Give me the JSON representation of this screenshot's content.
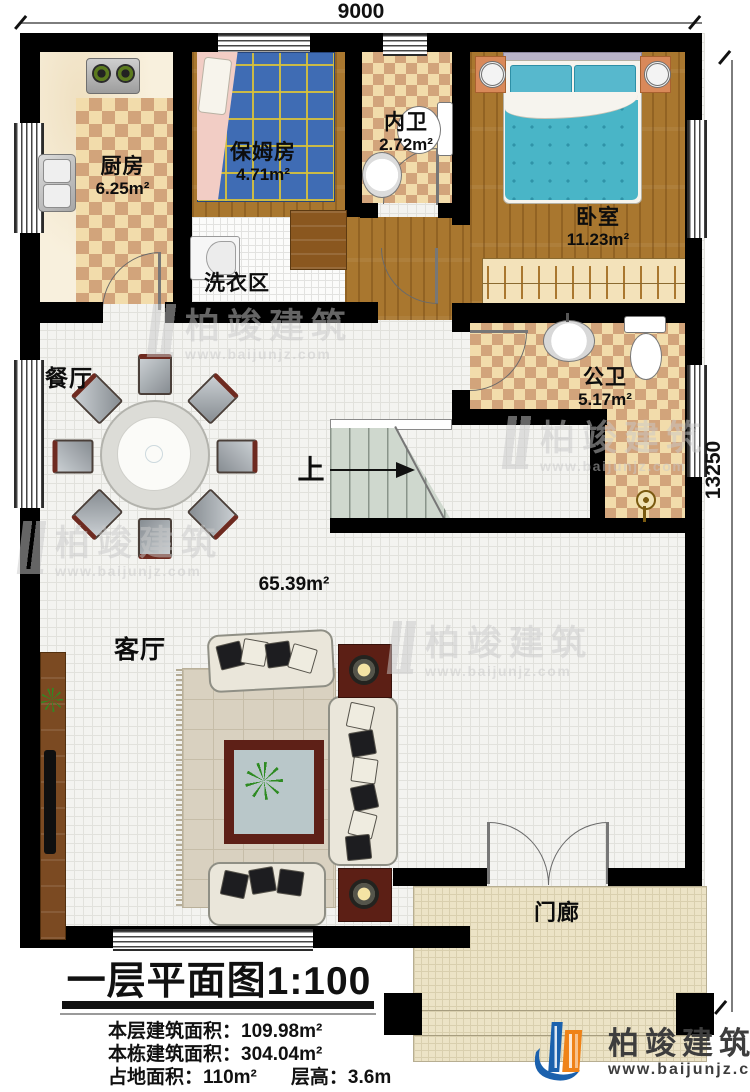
{
  "dimensions": {
    "top": "9000",
    "right": "13250"
  },
  "rooms": {
    "kitchen": {
      "name": "厨房",
      "area": "6.25m²"
    },
    "nanny": {
      "name": "保姆房",
      "area": "4.71m²"
    },
    "inner_bath": {
      "name": "内卫",
      "area": "2.72m²"
    },
    "bedroom": {
      "name": "卧室",
      "area": "11.23m²"
    },
    "laundry": {
      "name": "洗衣区"
    },
    "dining": {
      "name": "餐厅"
    },
    "public_bath": {
      "name": "公卫",
      "area": "5.17m²"
    },
    "living": {
      "name": "客厅",
      "floor_area": "65.39m²"
    },
    "porch": {
      "name": "门廊"
    },
    "stairs": {
      "up_label": "上"
    }
  },
  "title_block": {
    "title": "一层平面图1:100",
    "stats": [
      {
        "label": "本层建筑面积：",
        "value": "109.98m²"
      },
      {
        "label": "本栋建筑面积：",
        "value": "304.04m²"
      },
      {
        "label": "占地面积：",
        "value": "110m²"
      },
      {
        "label": "层高：",
        "value": "3.6m"
      }
    ]
  },
  "brand": {
    "name": "柏竣建筑",
    "url": "www.baijunjz.com"
  },
  "watermark": {
    "name": "柏竣建筑",
    "url": "www.baijunjz.com"
  },
  "colors": {
    "wall": "#000000",
    "wood": "#a9772f",
    "checker_light": "#f2dcab",
    "checker_dark": "#d2a47b",
    "bed_teal": "#49b5c7",
    "nanny_bed_blue": "#3f6cb4",
    "stair_green": "#cfd8ce",
    "brand_blue": "#1b61ad",
    "brand_orange": "#ef8218"
  }
}
